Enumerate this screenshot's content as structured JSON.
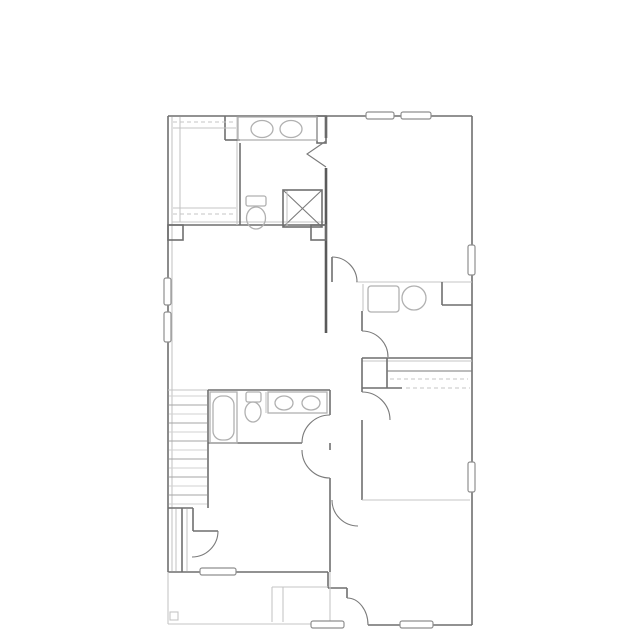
{
  "canvas": {
    "width": 639,
    "height": 639,
    "background": "#ffffff"
  },
  "palette": {
    "wall": "#6f6f6f",
    "wall_thin": "#7a7a7a",
    "wall_thick": "#5a5a5a",
    "light": "#c5c5c5",
    "fixture": "#b0b0b0",
    "window_border": "#8f8f8f",
    "window_fill": "#ffffff",
    "stair_dark": "#a6a6a6",
    "stair_light": "#d2d2d2"
  },
  "styles": {
    "w": {
      "stroke": "wall",
      "width": 1.6,
      "dash": null
    },
    "w1": {
      "stroke": "wall_thin",
      "width": 1.1,
      "dash": null
    },
    "t": {
      "stroke": "wall_thick",
      "width": 2.6,
      "dash": null
    },
    "l": {
      "stroke": "light",
      "width": 1.1,
      "dash": null
    },
    "ld": {
      "stroke": "light",
      "width": 1.1,
      "dash": "4,3"
    },
    "f": {
      "stroke": "fixture",
      "width": 1.3,
      "dash": null
    },
    "s0": {
      "stroke": "stair_dark",
      "width": 1.0,
      "dash": null
    },
    "s1": {
      "stroke": "stair_light",
      "width": 1.0,
      "dash": null
    }
  },
  "floorplan": {
    "lines": [
      [
        168,
        116,
        472,
        116,
        "w",
        "exterior-wall-top"
      ],
      [
        472,
        116,
        472,
        625,
        "w",
        "exterior-wall-right"
      ],
      [
        368,
        625,
        472,
        625,
        "w",
        "exterior-wall-bottom"
      ],
      [
        168,
        116,
        168,
        572,
        "w",
        "exterior-wall-left"
      ],
      [
        172,
        117,
        172,
        571,
        "l",
        "exterior-wall-left-inner"
      ],
      [
        168,
        572,
        328,
        572,
        "w",
        "exterior-wall-bottom-left"
      ],
      [
        328,
        572,
        328,
        588,
        "w",
        "entry-step-wall"
      ],
      [
        328,
        588,
        347,
        588,
        "w",
        "entry-step-wall"
      ],
      [
        347,
        588,
        347,
        598,
        "w",
        "entry-step-wall"
      ],
      [
        326,
        116,
        326,
        138,
        "t",
        "center-wall-upper"
      ],
      [
        326,
        168,
        326,
        333,
        "t",
        "center-wall-upper"
      ],
      [
        330,
        390,
        330,
        415,
        "w",
        "center-wall-lower"
      ],
      [
        330,
        443,
        330,
        450,
        "w",
        "center-wall-lower"
      ],
      [
        330,
        478,
        330,
        572,
        "w",
        "center-wall-lower"
      ],
      [
        168,
        390,
        208,
        390,
        "l",
        "stair-top-edge"
      ],
      [
        208,
        390,
        330,
        390,
        "w",
        "hall-bath-top-wall"
      ],
      [
        208,
        390,
        208,
        508,
        "w",
        "stair-side-wall"
      ],
      [
        208,
        443,
        302,
        443,
        "w",
        "hall-bath-bottom-wall"
      ],
      [
        266,
        392,
        266,
        413,
        "l",
        "hall-bath-divider"
      ],
      [
        168,
        225,
        326,
        225,
        "w",
        "master-suite-wall"
      ],
      [
        172,
        222,
        324,
        222,
        "l",
        "master-suite-wall-inner"
      ],
      [
        180,
        117,
        180,
        222,
        "l",
        "closet-shelf-line"
      ],
      [
        237,
        117,
        237,
        225,
        "l",
        "closet-shelf-line"
      ],
      [
        240,
        143,
        240,
        225,
        "w",
        "closet-divider-wall"
      ],
      [
        225,
        116,
        225,
        140,
        "w",
        "closet-return-wall"
      ],
      [
        225,
        140,
        240,
        140,
        "w",
        "closet-return-wall"
      ],
      [
        173,
        128,
        236,
        128,
        "l",
        "closet-shelf-line"
      ],
      [
        173,
        122,
        236,
        122,
        "ld",
        "closet-rod-line"
      ],
      [
        173,
        208,
        236,
        208,
        "l",
        "closet-shelf-line"
      ],
      [
        173,
        214,
        236,
        214,
        "ld",
        "closet-rod-line"
      ],
      [
        356,
        282,
        472,
        282,
        "l",
        "laundry-top-wall"
      ],
      [
        363,
        284,
        363,
        311,
        "l",
        "laundry-left-wall"
      ],
      [
        362,
        311,
        362,
        331,
        "w",
        "laundry-left-wall"
      ],
      [
        442,
        282,
        442,
        305,
        "w",
        "laundry-corner-wall"
      ],
      [
        442,
        305,
        472,
        305,
        "w",
        "laundry-corner-wall"
      ],
      [
        362,
        358,
        472,
        358,
        "w",
        "stairwell-band-top"
      ],
      [
        362,
        361,
        472,
        361,
        "l",
        "stairwell-band-top-inner"
      ],
      [
        362,
        358,
        362,
        388,
        "w",
        "stairwell-band-left"
      ],
      [
        387,
        358,
        387,
        388,
        "w",
        "stairwell-band-divider"
      ],
      [
        387,
        371,
        472,
        371,
        "w1",
        "stairwell-band-rail"
      ],
      [
        390,
        379,
        468,
        379,
        "ld",
        "stairwell-band-shelf"
      ],
      [
        362,
        388,
        402,
        388,
        "w",
        "stairwell-band-bottom"
      ],
      [
        406,
        388,
        470,
        388,
        "ld",
        "stairwell-band-bottom-dashed"
      ],
      [
        362,
        388,
        362,
        392,
        "w",
        "hall-right-wall"
      ],
      [
        362,
        420,
        362,
        500,
        "w",
        "hall-right-wall"
      ],
      [
        362,
        500,
        470,
        500,
        "l",
        "bottom-right-room-top-wall"
      ],
      [
        168,
        508,
        193,
        508,
        "w",
        "stair-landing-wall"
      ],
      [
        182,
        508,
        182,
        572,
        "w",
        "bedroom3-closet-wall"
      ],
      [
        176,
        509,
        176,
        571,
        "l",
        "bedroom3-closet-line"
      ],
      [
        187,
        509,
        187,
        571,
        "l",
        "bedroom3-closet-line"
      ],
      [
        193,
        508,
        193,
        531,
        "w",
        "stair-landing-wall"
      ],
      [
        193,
        531,
        218,
        531,
        "w",
        "understairs-door-leaf"
      ],
      [
        332,
        257,
        332,
        282,
        "w",
        "bedroom2-door-leaf"
      ],
      [
        168,
        572,
        168,
        624,
        "l",
        "porch-outline"
      ],
      [
        168,
        624,
        330,
        624,
        "l",
        "porch-outline"
      ],
      [
        330,
        572,
        330,
        624,
        "l",
        "porch-outline"
      ],
      [
        272,
        587,
        272,
        622,
        "l",
        "entry-stoop-line"
      ],
      [
        283,
        587,
        283,
        622,
        "l",
        "entry-stoop-line"
      ],
      [
        272,
        587,
        328,
        587,
        "l",
        "entry-stoop-line"
      ],
      [
        283,
        190,
        322,
        227,
        "w1",
        "shower-cross-line"
      ],
      [
        283,
        227,
        322,
        190,
        "w1",
        "shower-cross-line"
      ],
      [
        287,
        190,
        287,
        227,
        "l",
        "shower-edge-line"
      ]
    ],
    "rects": [
      [
        317,
        116,
        9,
        27,
        0,
        "w",
        "none",
        "wall-jog"
      ],
      [
        168,
        225,
        15,
        15,
        0,
        "w",
        "none",
        "wall-pier"
      ],
      [
        311,
        225,
        15,
        15,
        0,
        "w",
        "none",
        "wall-pier"
      ],
      [
        283,
        190,
        39,
        37,
        0,
        "w",
        "none",
        "shower"
      ],
      [
        238,
        117,
        79,
        23,
        0,
        "f",
        "none",
        "vanity-counter-master"
      ],
      [
        246,
        196,
        20,
        10,
        2,
        "f",
        "none",
        "toilet-tank-master"
      ],
      [
        368,
        286,
        31,
        26,
        3,
        "f",
        "none",
        "washer"
      ],
      [
        210,
        392,
        27,
        51,
        0,
        "f",
        "none",
        "bathtub"
      ],
      [
        213,
        396,
        21,
        44,
        9,
        "f",
        "none",
        "bathtub-basin"
      ],
      [
        246,
        392,
        15,
        10,
        2,
        "f",
        "none",
        "toilet-tank-hall"
      ],
      [
        268,
        392,
        59,
        21,
        0,
        "f",
        "none",
        "vanity-counter-hall"
      ],
      [
        170,
        612,
        8,
        8,
        0,
        "l",
        "none",
        "porch-post"
      ],
      [
        366,
        112,
        28,
        7,
        2,
        "winb",
        "winf",
        "window"
      ],
      [
        401,
        112,
        30,
        7,
        2,
        "winb",
        "winf",
        "window"
      ],
      [
        468,
        245,
        7,
        30,
        2,
        "winb",
        "winf",
        "window"
      ],
      [
        468,
        462,
        7,
        30,
        2,
        "winb",
        "winf",
        "window"
      ],
      [
        164,
        278,
        7,
        27,
        2,
        "winb",
        "winf",
        "window"
      ],
      [
        164,
        312,
        7,
        30,
        2,
        "winb",
        "winf",
        "window"
      ],
      [
        200,
        568,
        36,
        7,
        2,
        "winb",
        "winf",
        "window"
      ],
      [
        311,
        621,
        33,
        7,
        2,
        "winb",
        "winf",
        "window"
      ],
      [
        400,
        621,
        33,
        7,
        2,
        "winb",
        "winf",
        "window"
      ]
    ],
    "ellipses": [
      [
        262,
        129,
        11,
        8.5,
        "f",
        "sink-basin"
      ],
      [
        291,
        129,
        11,
        8.5,
        "f",
        "sink-basin"
      ],
      [
        256,
        218,
        9.5,
        11,
        "f",
        "toilet-bowl"
      ],
      [
        414,
        298,
        12,
        12,
        "f",
        "utility-sink"
      ],
      [
        253,
        412,
        8,
        10,
        "f",
        "toilet-bowl"
      ],
      [
        284,
        403,
        9,
        7,
        "f",
        "sink-basin"
      ],
      [
        311,
        403,
        9,
        7,
        "f",
        "sink-basin"
      ]
    ],
    "paths": [
      [
        "M326,141 L307,154 L326,167",
        "w1",
        "bifold-door-master-bath"
      ],
      [
        "M332,257 A25,25 0 0 1 357,282",
        "w1",
        "door-swing-bedroom2"
      ],
      [
        "M388,357 A26,26 0 0 0 362,331",
        "w1",
        "door-swing-laundry"
      ],
      [
        "M362,392 A28,28 0 0 1 390,420",
        "w1",
        "door-swing-hall"
      ],
      [
        "M302,443 A28,28 0 0 1 330,415",
        "w1",
        "door-swing-hall-bath"
      ],
      [
        "M302,450 A28,28 0 0 0 330,478",
        "w1",
        "door-swing-bedroom3"
      ],
      [
        "M218,531 A26,26 0 0 1 192,557",
        "w1",
        "door-swing-understairs"
      ],
      [
        "M332,500 A26,26 0 0 0 358,526",
        "w1",
        "door-swing-bottom-room"
      ],
      [
        "M347,598 A21,27 0 0 1 368,625",
        "w1",
        "door-swing-entry"
      ]
    ],
    "stairs": {
      "x1": 169,
      "x2": 207,
      "tread_ys": [
        396,
        405,
        414,
        423,
        432,
        441,
        450,
        459,
        468,
        477,
        486,
        495,
        504
      ]
    }
  }
}
